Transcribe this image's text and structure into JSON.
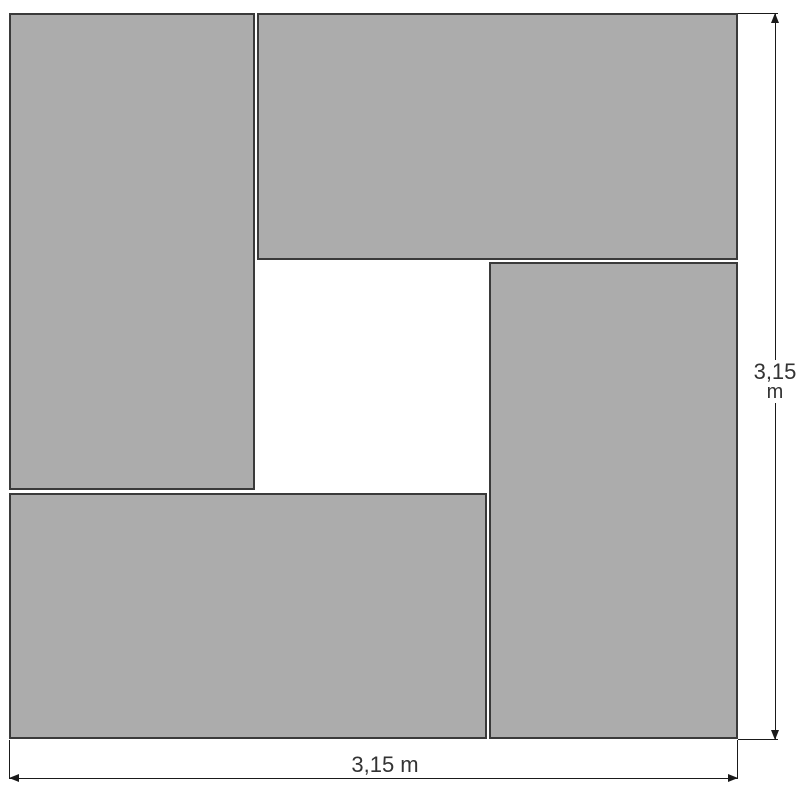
{
  "figure": {
    "type": "geometry-diagram",
    "description": "A large square outline made of four congruent gray rectangles arranged in a pinwheel pattern around a central white square; overall side length annotated on the right and bottom with dimension lines",
    "panels": [
      {
        "name": "top-left-rectangle",
        "fill": "gray"
      },
      {
        "name": "top-right-rectangle",
        "fill": "gray"
      },
      {
        "name": "right-rectangle",
        "fill": "gray"
      },
      {
        "name": "bottom-left-rectangle",
        "fill": "gray"
      },
      {
        "name": "center-square-void",
        "fill": "white"
      }
    ],
    "dimensions": {
      "right": {
        "value": "3,15",
        "unit": "m"
      },
      "bottom": {
        "label": "3,15 m"
      }
    }
  },
  "colors": {
    "panel-fill": "#ACACAC",
    "panel-edge": "#3A3A3A",
    "dim-line": "#1A1A1A",
    "dim-text": "#333333",
    "background": "#FFFFFF"
  }
}
